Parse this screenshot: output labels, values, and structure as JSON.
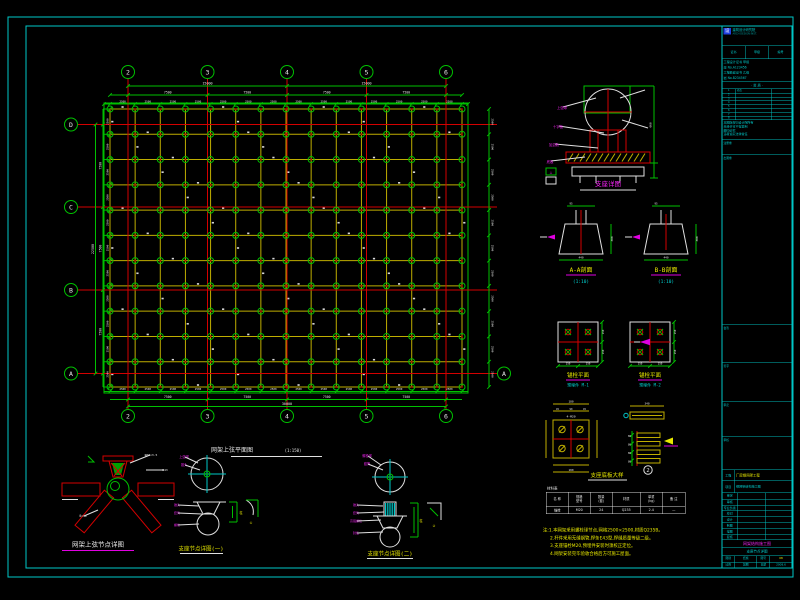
{
  "plan": {
    "title": "网架上弦平面图",
    "scale": "(1:150)",
    "axes_x": [
      "2",
      "3",
      "4",
      "5",
      "6"
    ],
    "axes_y": [
      "D",
      "C",
      "B",
      "A"
    ],
    "right_axis": "A",
    "dims": {
      "module": "2500",
      "bay": "7500",
      "half": "15000",
      "total": "30000",
      "bay_y": "7500",
      "total_y": "22500"
    }
  },
  "details": {
    "support": {
      "title": "支座详图",
      "labels": [
        "上弦球",
        "十字板",
        "加劲肋",
        "底板"
      ],
      "dim": "660"
    },
    "trap1": {
      "title": "A-A剖面",
      "scale": "(1:10)",
      "w": "440",
      "h": "300",
      "stub": "95"
    },
    "trap2": {
      "title": "B-B剖面",
      "scale": "(1:10)",
      "w": "440",
      "h": "300",
      "stub": "95"
    },
    "plate1": {
      "title": "锚栓平面",
      "sub": "预埋件 M-1",
      "plate_dim": "150"
    },
    "plate2": {
      "title": "锚栓平面",
      "sub": "预埋件 M-2",
      "plate_dim": "150"
    },
    "base": {
      "title": "支座底板大样",
      "num": "2",
      "top_label": "4-M20",
      "plate_dim": "180",
      "bar_dim": "340",
      "rib_dim": "80",
      "edge_dim": "45",
      "mid_dim": "90"
    },
    "node_bl": {
      "title": "网架上弦节点详图",
      "labels": [
        "φ60×3.5",
        "E43",
        "δ=10"
      ]
    },
    "mid1": {
      "title": "支座节点详图(一)",
      "top_labels": [
        "上弦球",
        "锥头"
      ],
      "leader_labels": [
        "锥头",
        "套筒",
        "螺栓"
      ],
      "bracket_label": "柱",
      "note": "①"
    },
    "mid2": {
      "title": "支座节点详图(二)",
      "top_labels": [
        "螺栓球",
        "套筒"
      ],
      "leader_labels": [
        "锥头",
        "套筒",
        "高强螺栓",
        "封板"
      ],
      "bracket_label": "柱",
      "note": "②"
    }
  },
  "table": {
    "caption": "材料表",
    "headers": [
      "名 称",
      "规格\n型号",
      "数量\n(套)",
      "材质",
      "单重\n(kg)",
      "备 注"
    ],
    "row": [
      "锚栓",
      "M20",
      "24",
      "Q235",
      "2.4",
      "—"
    ]
  },
  "notes": [
    "注:1.本网架采用螺栓球节点,网格2500×2500,材质Q235B。",
    "2.杆件采用无缝钢管,焊条E43型,焊缝质量等级二级。",
    "3.支座锚栓M20,预埋件安装时须校正定位。",
    "4.网架安装完毕验收合格后方可施工屋面。"
  ],
  "titleblock": {
    "logo_text": "建筑设计研究院",
    "logo_sub": "ARCH DESIGN INST.",
    "cert_cells": [
      "证书",
      "甲级",
      "编号"
    ],
    "cert_lines": [
      "工程设计证书 甲级",
      "建 No.A123456",
      "工程勘察证书 乙级",
      "岩 No.B234567"
    ],
    "divider": "· 资 质 ·",
    "sign_rows": [
      [
        "1",
        "修改"
      ],
      [
        "2",
        ""
      ],
      [
        "3",
        ""
      ],
      [
        "4",
        ""
      ],
      [
        "5",
        ""
      ],
      [
        "6",
        ""
      ],
      [
        "7",
        ""
      ],
      [
        "8",
        ""
      ]
    ],
    "para_lines": [
      "本图版权归设计院所有",
      "未经许可不得复制",
      "翻印必究",
      "违者追究法律责任",
      ""
    ],
    "stamp_labels": [
      "注册章",
      "出图章",
      "会签",
      "签字",
      "审定",
      "审核"
    ],
    "project_label": "工程",
    "project_value": "厂房钢网架工程",
    "item_label": "项目",
    "item_value": "钢网架结构施工图",
    "staff_rows": [
      [
        "审定",
        ""
      ],
      [
        "审核",
        ""
      ],
      [
        "专业负责",
        ""
      ],
      [
        "校对",
        ""
      ],
      [
        "设计",
        ""
      ],
      [
        "制图",
        ""
      ],
      [
        "描图",
        ""
      ],
      [
        "复核",
        ""
      ]
    ],
    "drawing_title": "网架结构施工图",
    "drawing_sub": "支座节点详图",
    "bottom_rows": [
      [
        [
          "图别",
          "结施"
        ],
        [
          "图号",
          "08"
        ]
      ],
      [
        [
          "比例",
          "如图"
        ],
        [
          "日期",
          "2008.6"
        ]
      ]
    ]
  }
}
